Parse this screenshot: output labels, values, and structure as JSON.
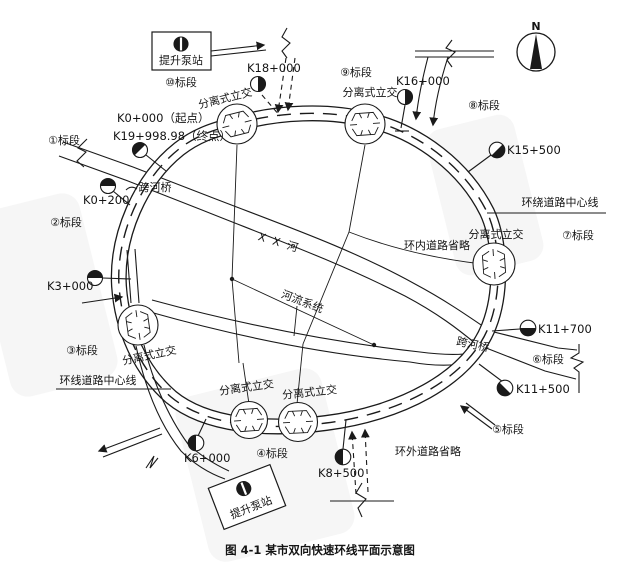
{
  "figure": {
    "caption": "图 4-1  某市双向快速环线平面示意图"
  },
  "compass": {
    "label": "N"
  },
  "legend_labels": {
    "interchange": "分离式立交",
    "pump_station": "提升泵站",
    "river_bridge": "跨河桥",
    "river_name": "X X 河",
    "river_system": "河流系统",
    "ring_centerline_outer": "环绕道路中心线",
    "ring_centerline": "环线道路中心线",
    "inner_roads_omitted": "环内道路省略",
    "outer_roads_omitted": "环外道路省略"
  },
  "sections": {
    "s1": "①标段",
    "s2": "②标段",
    "s3": "③标段",
    "s4": "④标段",
    "s5": "⑤标段",
    "s6": "⑥标段",
    "s7": "⑦标段",
    "s8": "⑧标段",
    "s9": "⑨标段",
    "s10": "⑩标段"
  },
  "stations": {
    "start": "K0+000（起点）",
    "end": "K19+998.98（终点）",
    "k0_200": "K0+200",
    "k3_000": "K3+000",
    "k6_000": "K6+000",
    "k8_500": "K8+500",
    "k11_500": "K11+500",
    "k11_700": "K11+700",
    "k15_500": "K15+500",
    "k16_000": "K16+000",
    "k18_000": "K18+000"
  }
}
